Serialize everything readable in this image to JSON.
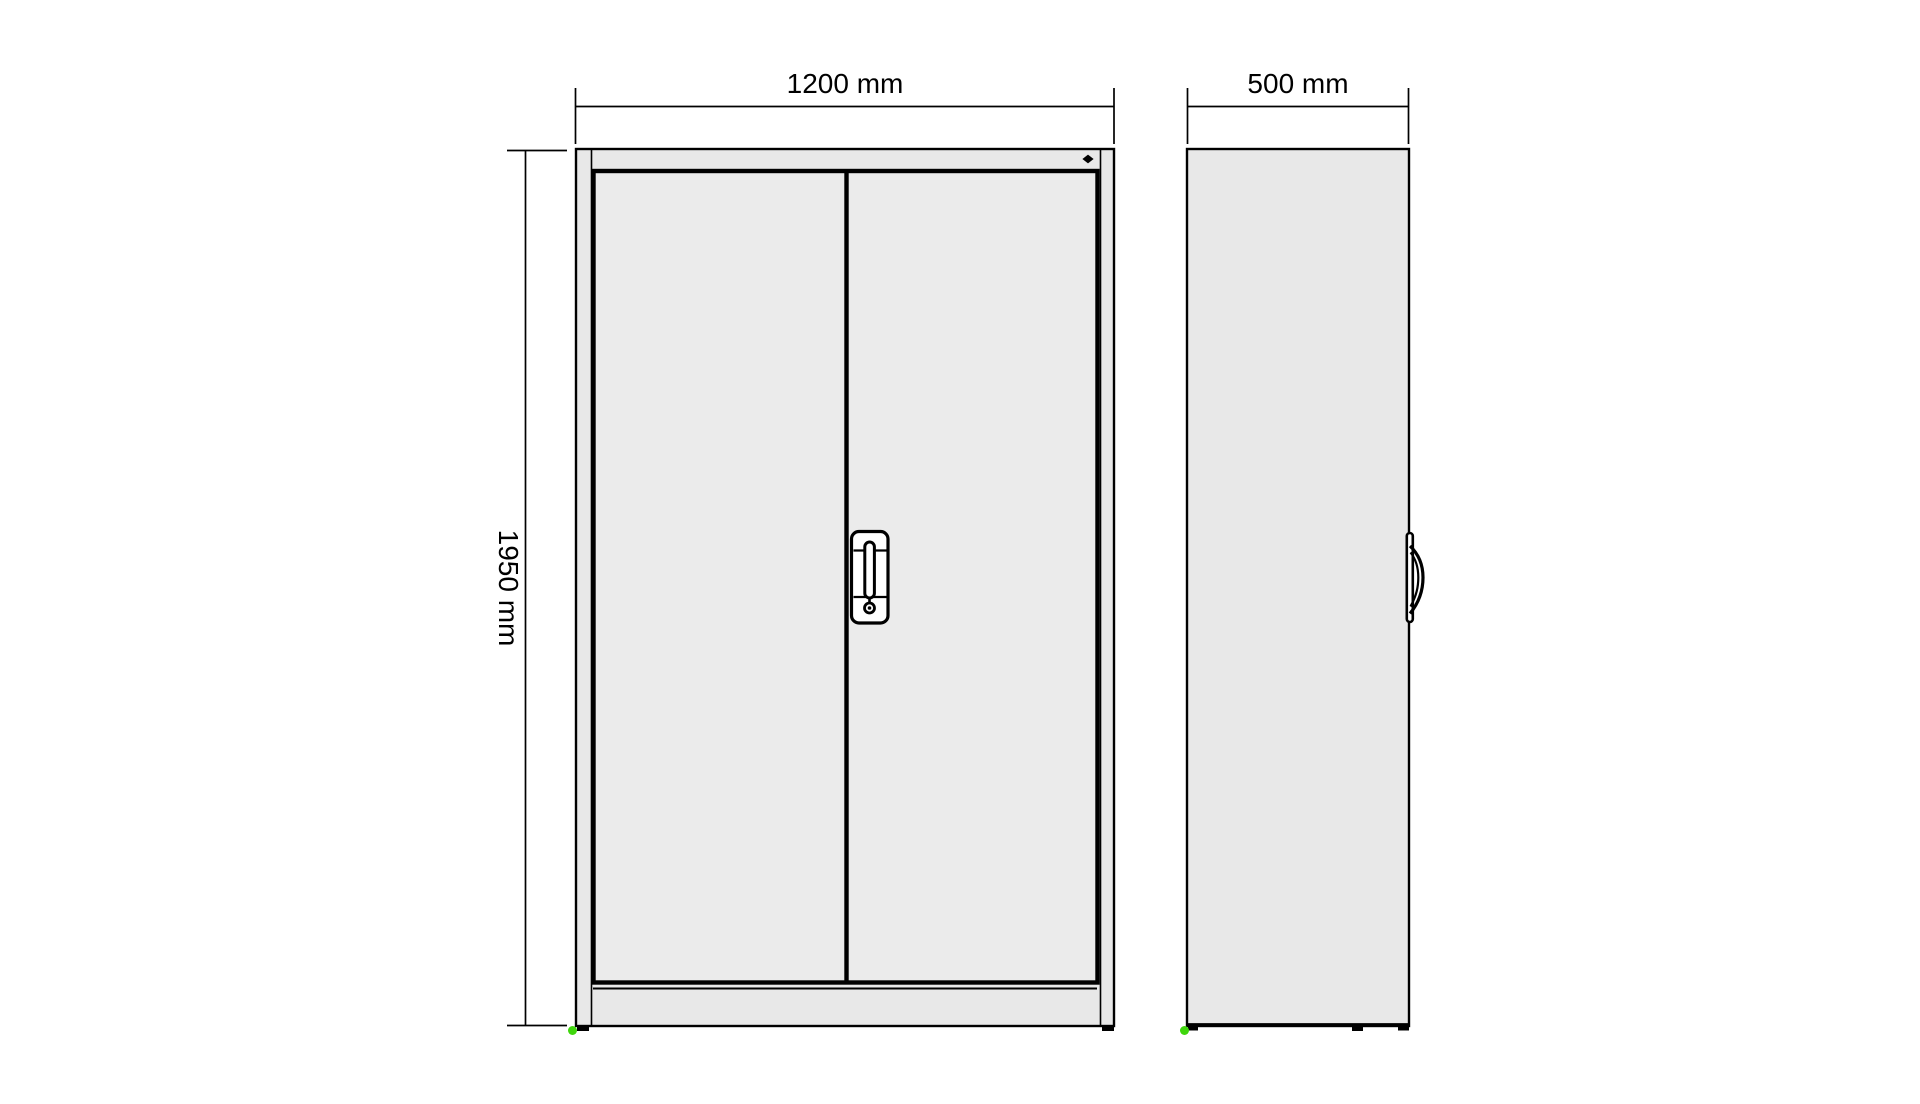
{
  "labels": {
    "front_width": "1200 mm",
    "front_height": "1950 mm",
    "side_depth": "500 mm"
  },
  "colors": {
    "background": "#ffffff",
    "line": "#000000",
    "frame_fill": "#e8e8e8",
    "door_fill": "#ebebeb",
    "handle_fill": "#ffffff",
    "foot_black": "#000000",
    "marker_green": "#3fd60c"
  },
  "icons": {
    "lock_marker": "diamond",
    "corner_marker": "green-dot"
  }
}
